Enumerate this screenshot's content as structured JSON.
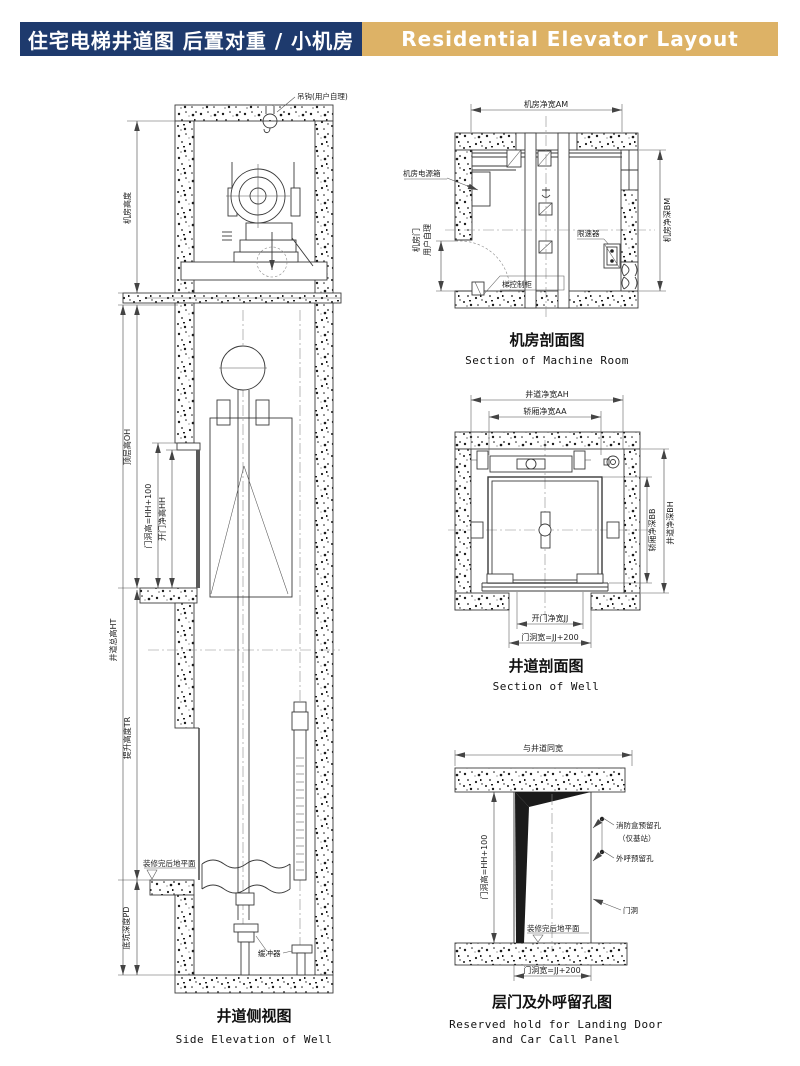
{
  "header": {
    "title_cn": "住宅电梯井道图 后置对重 / 小机房",
    "title_en": "Residential Elevator Layout",
    "navy_color": "#1e3a6d",
    "gold_color": "#ddb266"
  },
  "side_elevation": {
    "hook": "吊钩(用户自理)",
    "machine_room_height": "机房高度",
    "top_floor_height": "顶层高OH",
    "door_hole_height": "门洞高=HH+100",
    "door_clear_height": "开门净高HH",
    "well_total_height": "井道总高HT",
    "travel_height": "提升高度TR",
    "pit_depth": "底坑深度PD",
    "finished_floor": "装修完后地平面",
    "buffer": "缓冲器",
    "caption_cn": "井道侧视图",
    "caption_en": "Side Elevation of Well"
  },
  "machine_room": {
    "clear_width": "机房净宽AM",
    "clear_depth": "机房净深BM",
    "power_box": "机房电源箱",
    "door_line1": "机房门",
    "door_line2": "用户自理",
    "control_cabinet": "梯控制柜",
    "governor": "限速器",
    "caption_cn": "机房剖面图",
    "caption_en": "Section of Machine Room"
  },
  "well_section": {
    "well_width": "井道净宽AH",
    "car_width": "轿厢净宽AA",
    "car_depth": "轿厢净深BB",
    "well_depth": "井道净深BH",
    "door_clear_width": "开门净宽JJ",
    "door_hole_width": "门洞宽=JJ+200",
    "caption_cn": "井道剖面图",
    "caption_en": "Section of Well"
  },
  "landing_door": {
    "same_as_well": "与井道同宽",
    "door_hole_height": "门洞高=HH+100",
    "fire_box_line1": "消防盒预留孔",
    "fire_box_line2": "（仅基站）",
    "call_box": "外呼预留孔",
    "door_hole": "门洞",
    "finished_floor": "装修完后地平面",
    "door_hole_width": "门洞宽=JJ+200",
    "caption_cn": "层门及外呼留孔图",
    "caption_en1": "Reserved hold for Landing Door",
    "caption_en2": "and Car Call Panel"
  }
}
